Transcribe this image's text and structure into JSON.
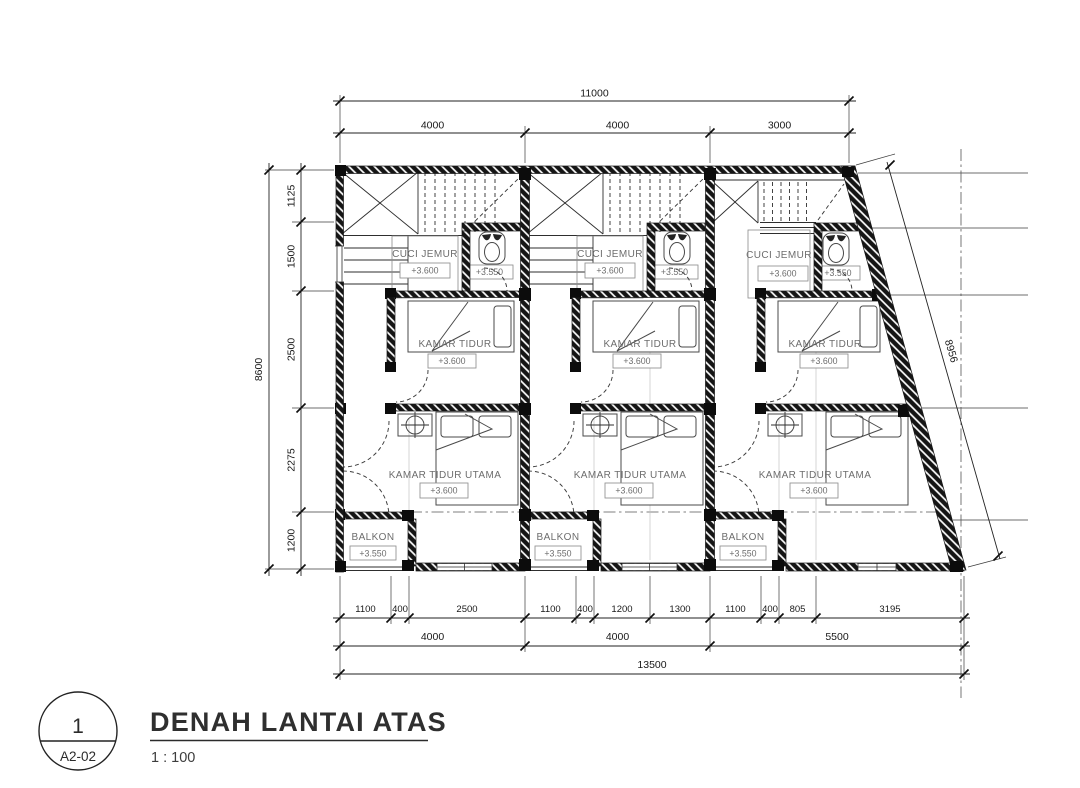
{
  "title_block": {
    "detail_number": "1",
    "sheet_code": "A2-02",
    "title": "DENAH LANTAI ATAS",
    "scale": "1 : 100"
  },
  "dimensions": {
    "top_total": "11000",
    "top_bays": [
      "4000",
      "4000",
      "3000"
    ],
    "left_total": "8600",
    "left_segments": [
      "1125",
      "1500",
      "2500",
      "2275",
      "1200"
    ],
    "bottom_segments": [
      "1100",
      "400",
      "2500",
      "1100",
      "400",
      "1200",
      "1300",
      "1100",
      "400",
      "805",
      "3195"
    ],
    "bottom_bays": [
      "4000",
      "4000",
      "5500"
    ],
    "bottom_total": "13500",
    "slant_length": "8956"
  },
  "units": [
    {
      "cuci_jemur": {
        "label": "CUCI JEMUR",
        "level": "+3.600"
      },
      "toilet": {
        "level": "+3.550"
      },
      "kamar_tidur": {
        "label": "KAMAR TIDUR",
        "level": "+3.600"
      },
      "kamar_tidur_utama": {
        "label": "KAMAR TIDUR UTAMA",
        "level": "+3.600"
      },
      "balkon": {
        "label": "BALKON",
        "level": "+3.550"
      }
    },
    {
      "cuci_jemur": {
        "label": "CUCI JEMUR",
        "level": "+3.600"
      },
      "toilet": {
        "level": "+3.550"
      },
      "kamar_tidur": {
        "label": "KAMAR TIDUR",
        "level": "+3.600"
      },
      "kamar_tidur_utama": {
        "label": "KAMAR TIDUR UTAMA",
        "level": "+3.600"
      },
      "balkon": {
        "label": "BALKON",
        "level": "+3.550"
      }
    },
    {
      "cuci_jemur": {
        "label": "CUCI JEMUR",
        "level": "+3.600"
      },
      "toilet": {
        "level": "+3.550"
      },
      "kamar_tidur": {
        "label": "KAMAR TIDUR",
        "level": "+3.600"
      },
      "kamar_tidur_utama": {
        "label": "KAMAR TIDUR UTAMA",
        "level": "+3.600"
      },
      "balkon": {
        "label": "BALKON",
        "level": "+3.550"
      }
    }
  ],
  "colors": {
    "ink": "#1d1d1d",
    "label_gray": "#6d6d6d",
    "wall_fill": "#151515"
  }
}
